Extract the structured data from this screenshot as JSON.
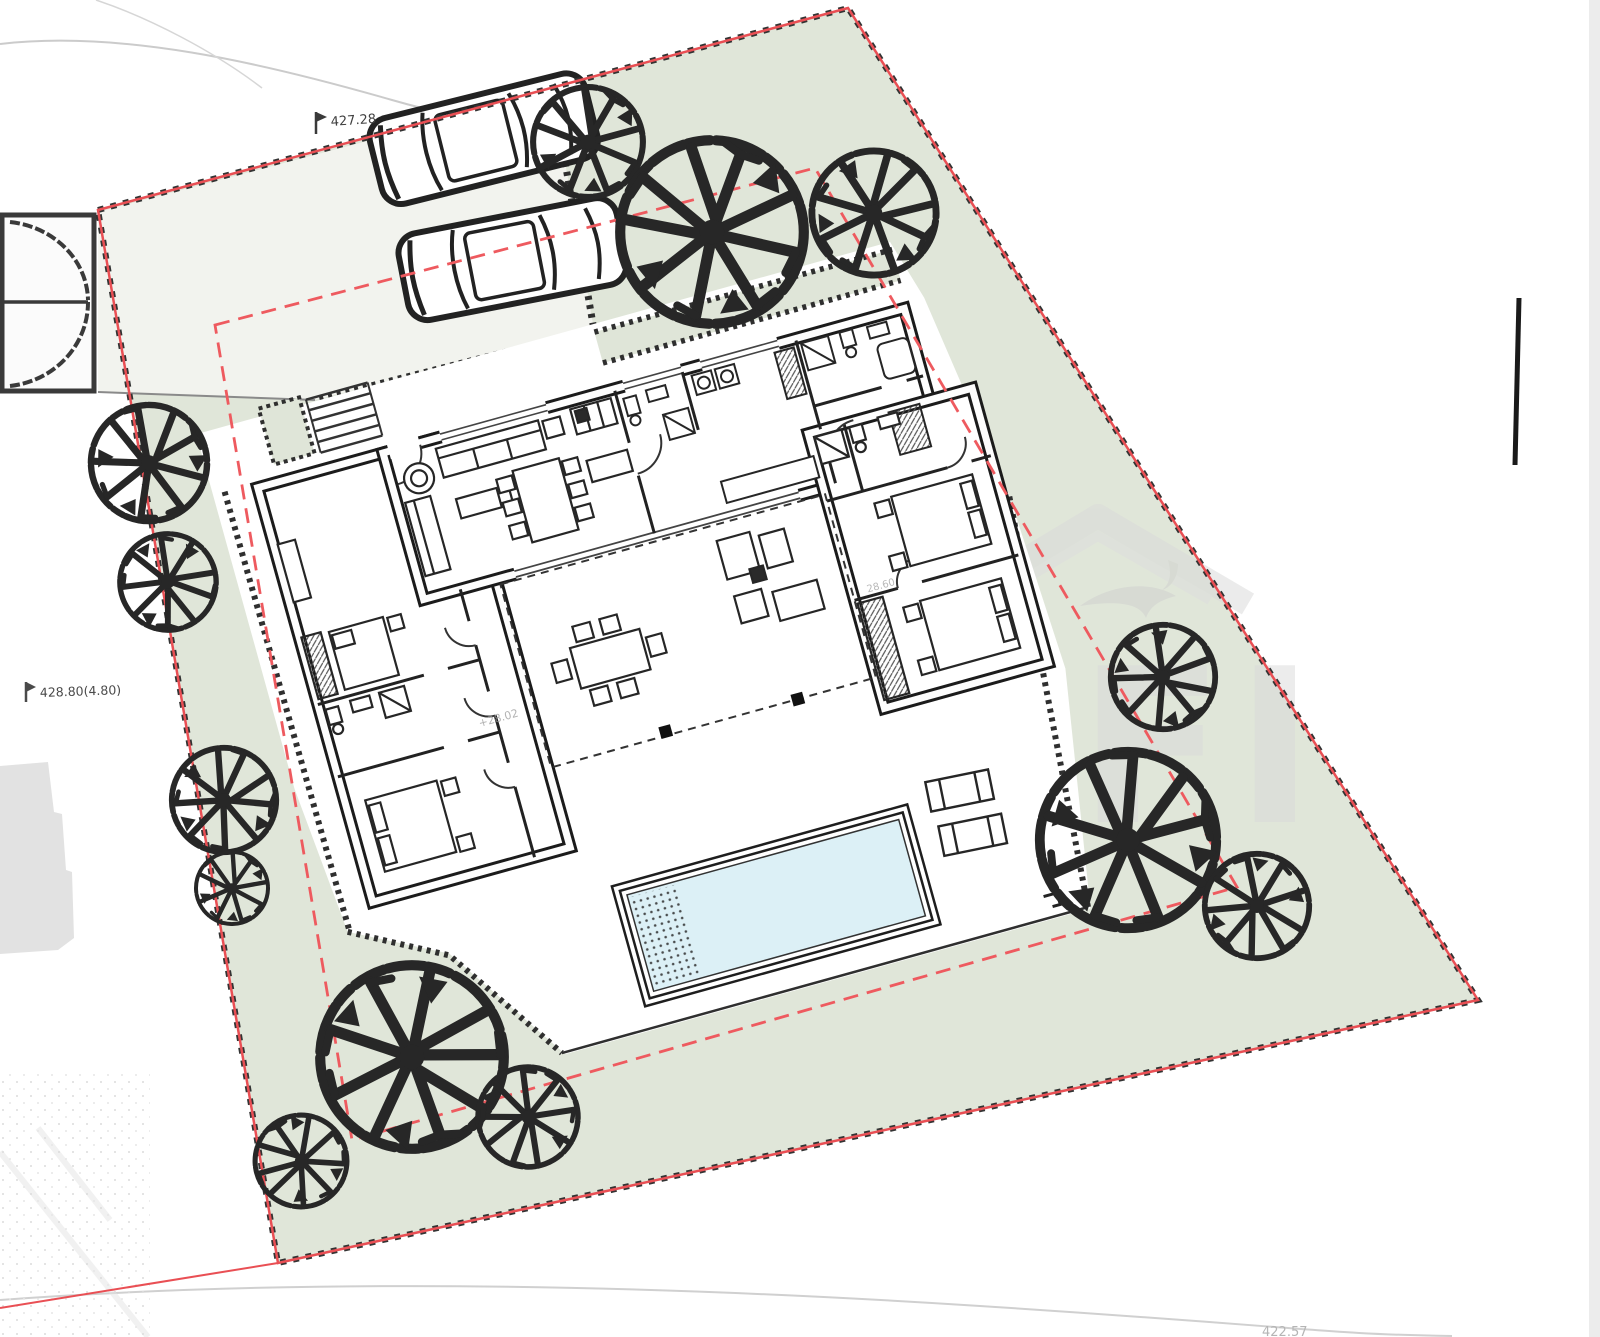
{
  "page": {
    "background": "#ffffff",
    "description": "Architectural site plan — villa ground floor with swimming pool, parking court and perimeter garden"
  },
  "annotations": {
    "elevation_top": "427.28",
    "elevation_left": "428.80(4.80)",
    "elevation_bottom_right": "422.57",
    "terrace_level": "+28.02",
    "hall_level": "28.60"
  },
  "watermark": {
    "letters": "FI"
  },
  "colors": {
    "plot_green": "#e0e6d9",
    "driveway_grey": "#f2f3ee",
    "pool_blue": "#dcf0f6",
    "boundary_red": "#e94f54",
    "setback_red": "#ee5a5f",
    "wall_dark": "#1d1d1d",
    "tree_dark": "#272727",
    "watermark_grey": "#d9d9d9"
  },
  "site": {
    "plot_boundary": "red solid survey line with black hatch ticks",
    "setback_line": "red dashed building-limit line",
    "trees_count": 13,
    "cars_count": 2,
    "sun_loungers_count": 2,
    "features": [
      "entrance gate with double swing leaves",
      "driveway with two parked cars",
      "entry steps flanked by planters",
      "villa with living wing, left bedroom wing and right bedroom wing",
      "covered terrace with outdoor dining and lounge furniture",
      "swimming pool with beach-entry dotted steps",
      "pool deck with two sun loungers",
      "perimeter garden with sketched trees"
    ]
  }
}
